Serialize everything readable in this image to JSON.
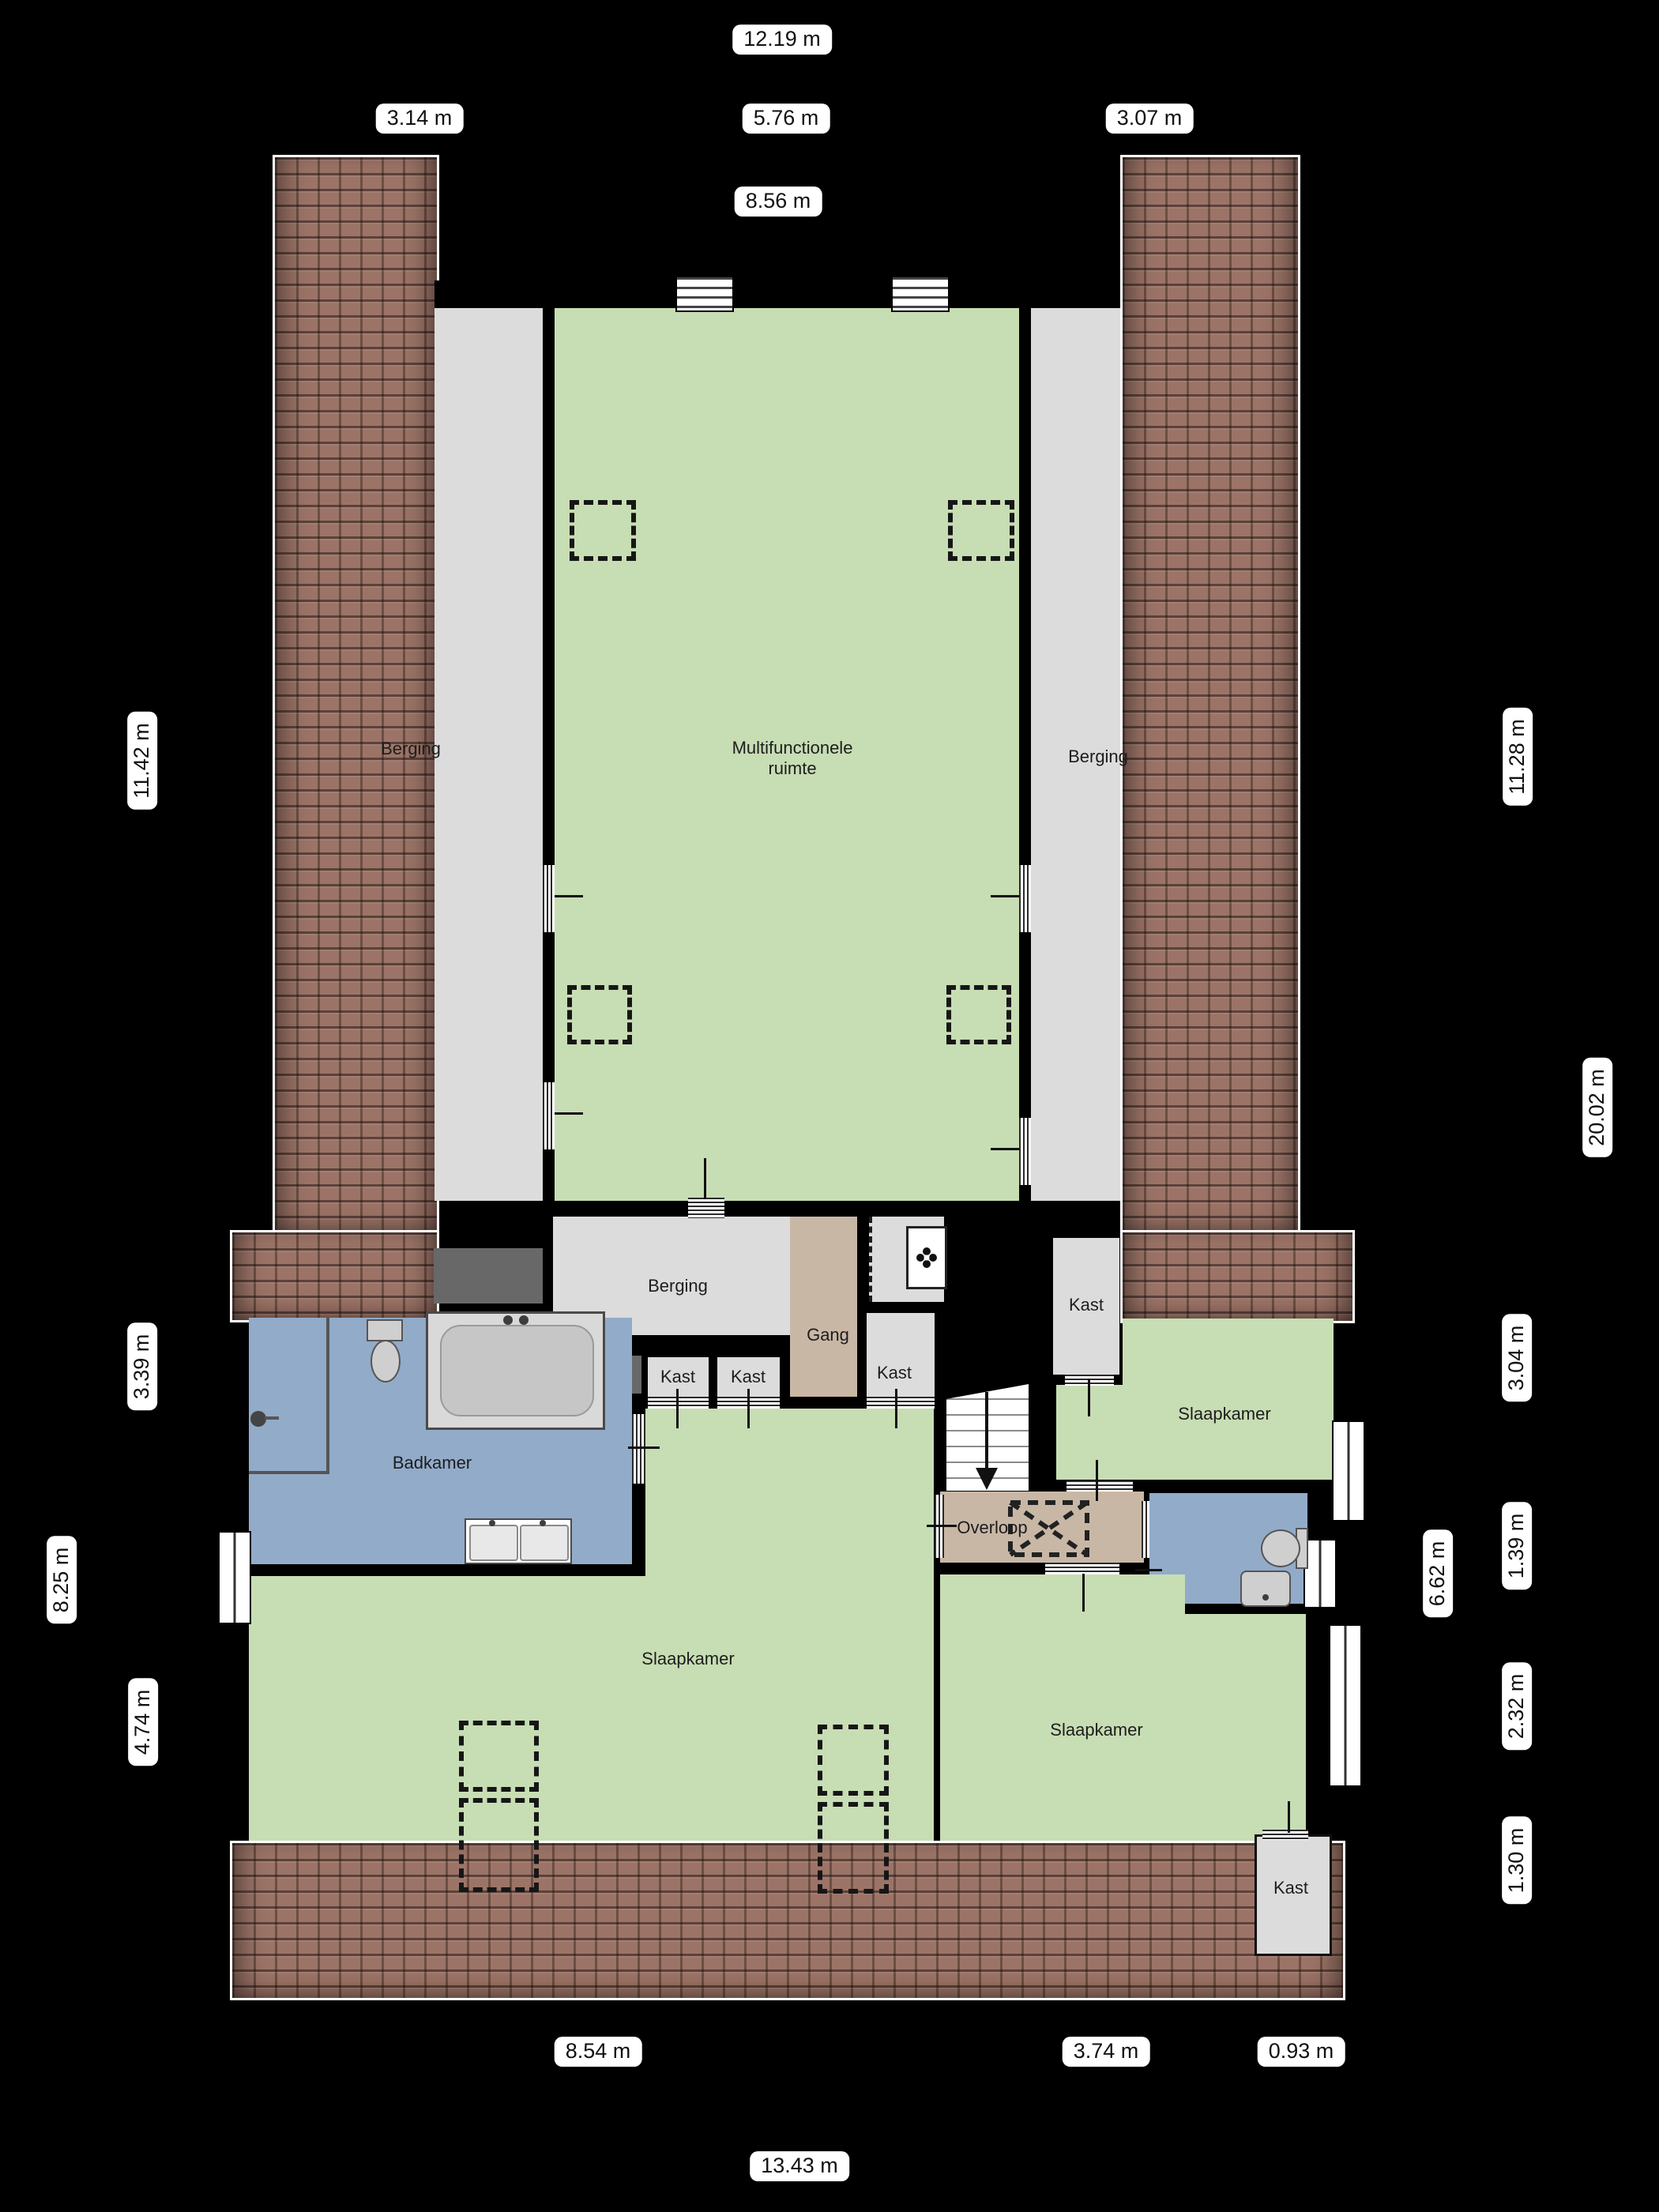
{
  "rooms": {
    "berging_left": {
      "label": "Berging"
    },
    "multifunctionele": {
      "label_line1": "Multifunctionele",
      "label_line2": "ruimte"
    },
    "berging_right": {
      "label": "Berging"
    },
    "berging_mid": {
      "label": "Berging"
    },
    "gang": {
      "label": "Gang"
    },
    "kast_a": {
      "label": "Kast"
    },
    "kast_b": {
      "label": "Kast"
    },
    "kast_c": {
      "label": "Kast"
    },
    "kast_d": {
      "label": "Kast"
    },
    "kast_e": {
      "label": "Kast"
    },
    "badkamer": {
      "label": "Badkamer"
    },
    "slaapkamer_left": {
      "label": "Slaapkamer"
    },
    "slaapkamer_topright": {
      "label": "Slaapkamer"
    },
    "slaapkamer_bottomright": {
      "label": "Slaapkamer"
    },
    "overloop": {
      "label": "Overloop"
    }
  },
  "dimensions": {
    "top": [
      "12.19 m",
      "3.14 m",
      "5.76 m",
      "3.07 m",
      "8.56 m"
    ],
    "bottom": [
      "8.54 m",
      "3.74 m",
      "0.93 m",
      "13.43 m"
    ],
    "left": [
      "11.42 m",
      "3.39 m",
      "8.25 m",
      "4.74 m"
    ],
    "right": [
      "11.28 m",
      "20.02 m",
      "3.04 m",
      "1.39 m",
      "6.62 m",
      "2.32 m",
      "1.30 m"
    ]
  },
  "colors": {
    "room_green": "#c7ddb3",
    "room_grey": "#dcdcdc",
    "room_tan": "#c9b7a6",
    "room_blue": "#92abc9",
    "roof": "#9c7467",
    "background": "#000000"
  }
}
